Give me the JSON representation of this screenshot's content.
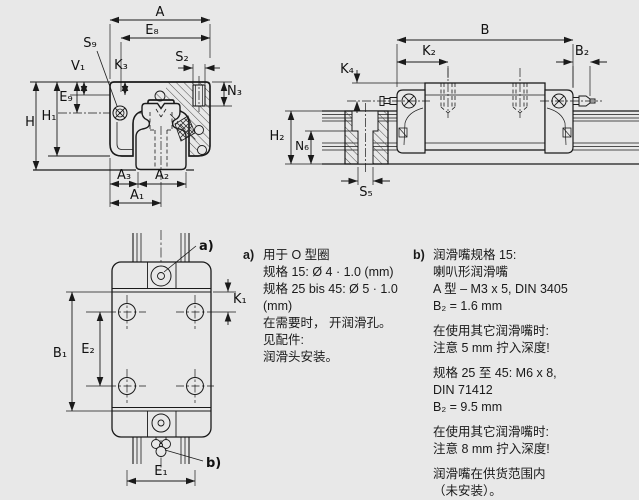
{
  "title": "linear guide carriage dimensional drawing",
  "colors": {
    "background": "#e8e8e8",
    "line": "#1a1a1a"
  },
  "dims": {
    "A": "A",
    "E8": "E₈",
    "S9": "S₉",
    "V1": "V₁",
    "K3": "K₃",
    "S2": "S₂",
    "N3": "N₃",
    "E9": "E₉",
    "H": "H",
    "H1": "H₁",
    "A3": "A₃",
    "A2": "A₂",
    "A1": "A₁",
    "B": "B",
    "K2": "K₂",
    "B2": "B₂",
    "K4": "K₄",
    "H2": "H₂",
    "N6": "N₆",
    "S5": "S₅",
    "K1": "K₁",
    "B1": "B₁",
    "E2": "E₂",
    "E1": "E₁"
  },
  "callouts": {
    "a": "a)",
    "b": "b)"
  },
  "notes": {
    "a": {
      "label": "a)",
      "lines": [
        "用于 O 型圈",
        "规格 15: Ø 4 · 1.0 (mm)",
        "规格 25 bis 45: Ø 5 · 1.0 (mm)",
        "在需要时， 开润滑孔。",
        "见配件:",
        "润滑头安装。"
      ]
    },
    "b": {
      "label": "b)",
      "paragraphs": [
        [
          "润滑嘴规格 15:",
          "喇叭形润滑嘴",
          "A 型 – M3 x 5, DIN 3405",
          "B₂ = 1.6 mm"
        ],
        [
          "在使用其它润滑嘴时:",
          "注意 5 mm 拧入深度!"
        ],
        [
          "规格 25 至 45: M6 x 8,",
          "DIN 71412",
          "B₂ = 9.5 mm"
        ],
        [
          "在使用其它润滑嘴时:",
          "注意 8 mm 拧入深度!"
        ],
        [
          "润滑嘴在供货范围内",
          "（未安装）。",
          "可安在任意面上。"
        ]
      ]
    }
  }
}
